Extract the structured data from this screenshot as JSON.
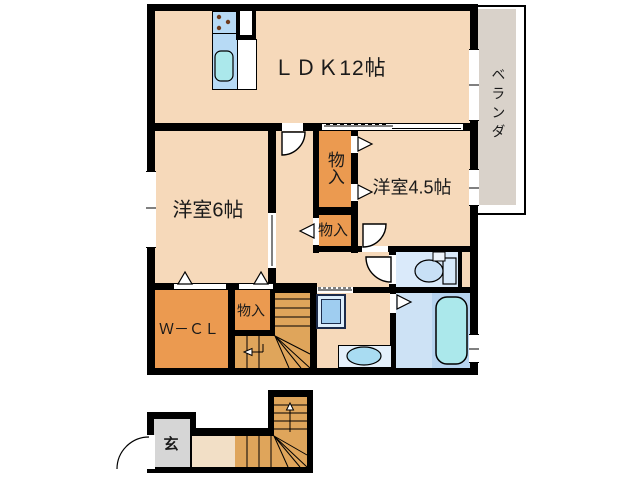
{
  "document": {
    "type": "floor-plan",
    "description": "2-story apartment unit floor plan, 2LDK with stairs and entrance below"
  },
  "labels": {
    "ldk": "ＬＤＫ12帖",
    "veranda": "ベランダ",
    "western_room_6": "洋室6帖",
    "western_room_45": "洋室4.5帖",
    "storage_upper": "物入",
    "storage_hall": "物入",
    "storage_stairs": "物入",
    "walk_in_closet": "Ｗ－ＣＬ",
    "entrance": "玄"
  },
  "colors": {
    "room_floor": "#f6d9ba",
    "entrance_hall_floor": "#f2dfc6",
    "closet": "#eb9a50",
    "stairs": "#dfa55b",
    "veranda": "#d9d2ca",
    "entrance_floor_gray": "#d6d6d6",
    "toilet_room": "#daeafa",
    "bathroom": "#cde2f5",
    "bathtub": "#abe8eb",
    "fixture_blue": "#b7daf5",
    "wall": "#000000"
  },
  "fixtures": [
    "kitchen-stove",
    "kitchen-sink",
    "kitchen-counter",
    "toilet",
    "bathtub",
    "washing-machine-pan",
    "vanity-sink"
  ]
}
